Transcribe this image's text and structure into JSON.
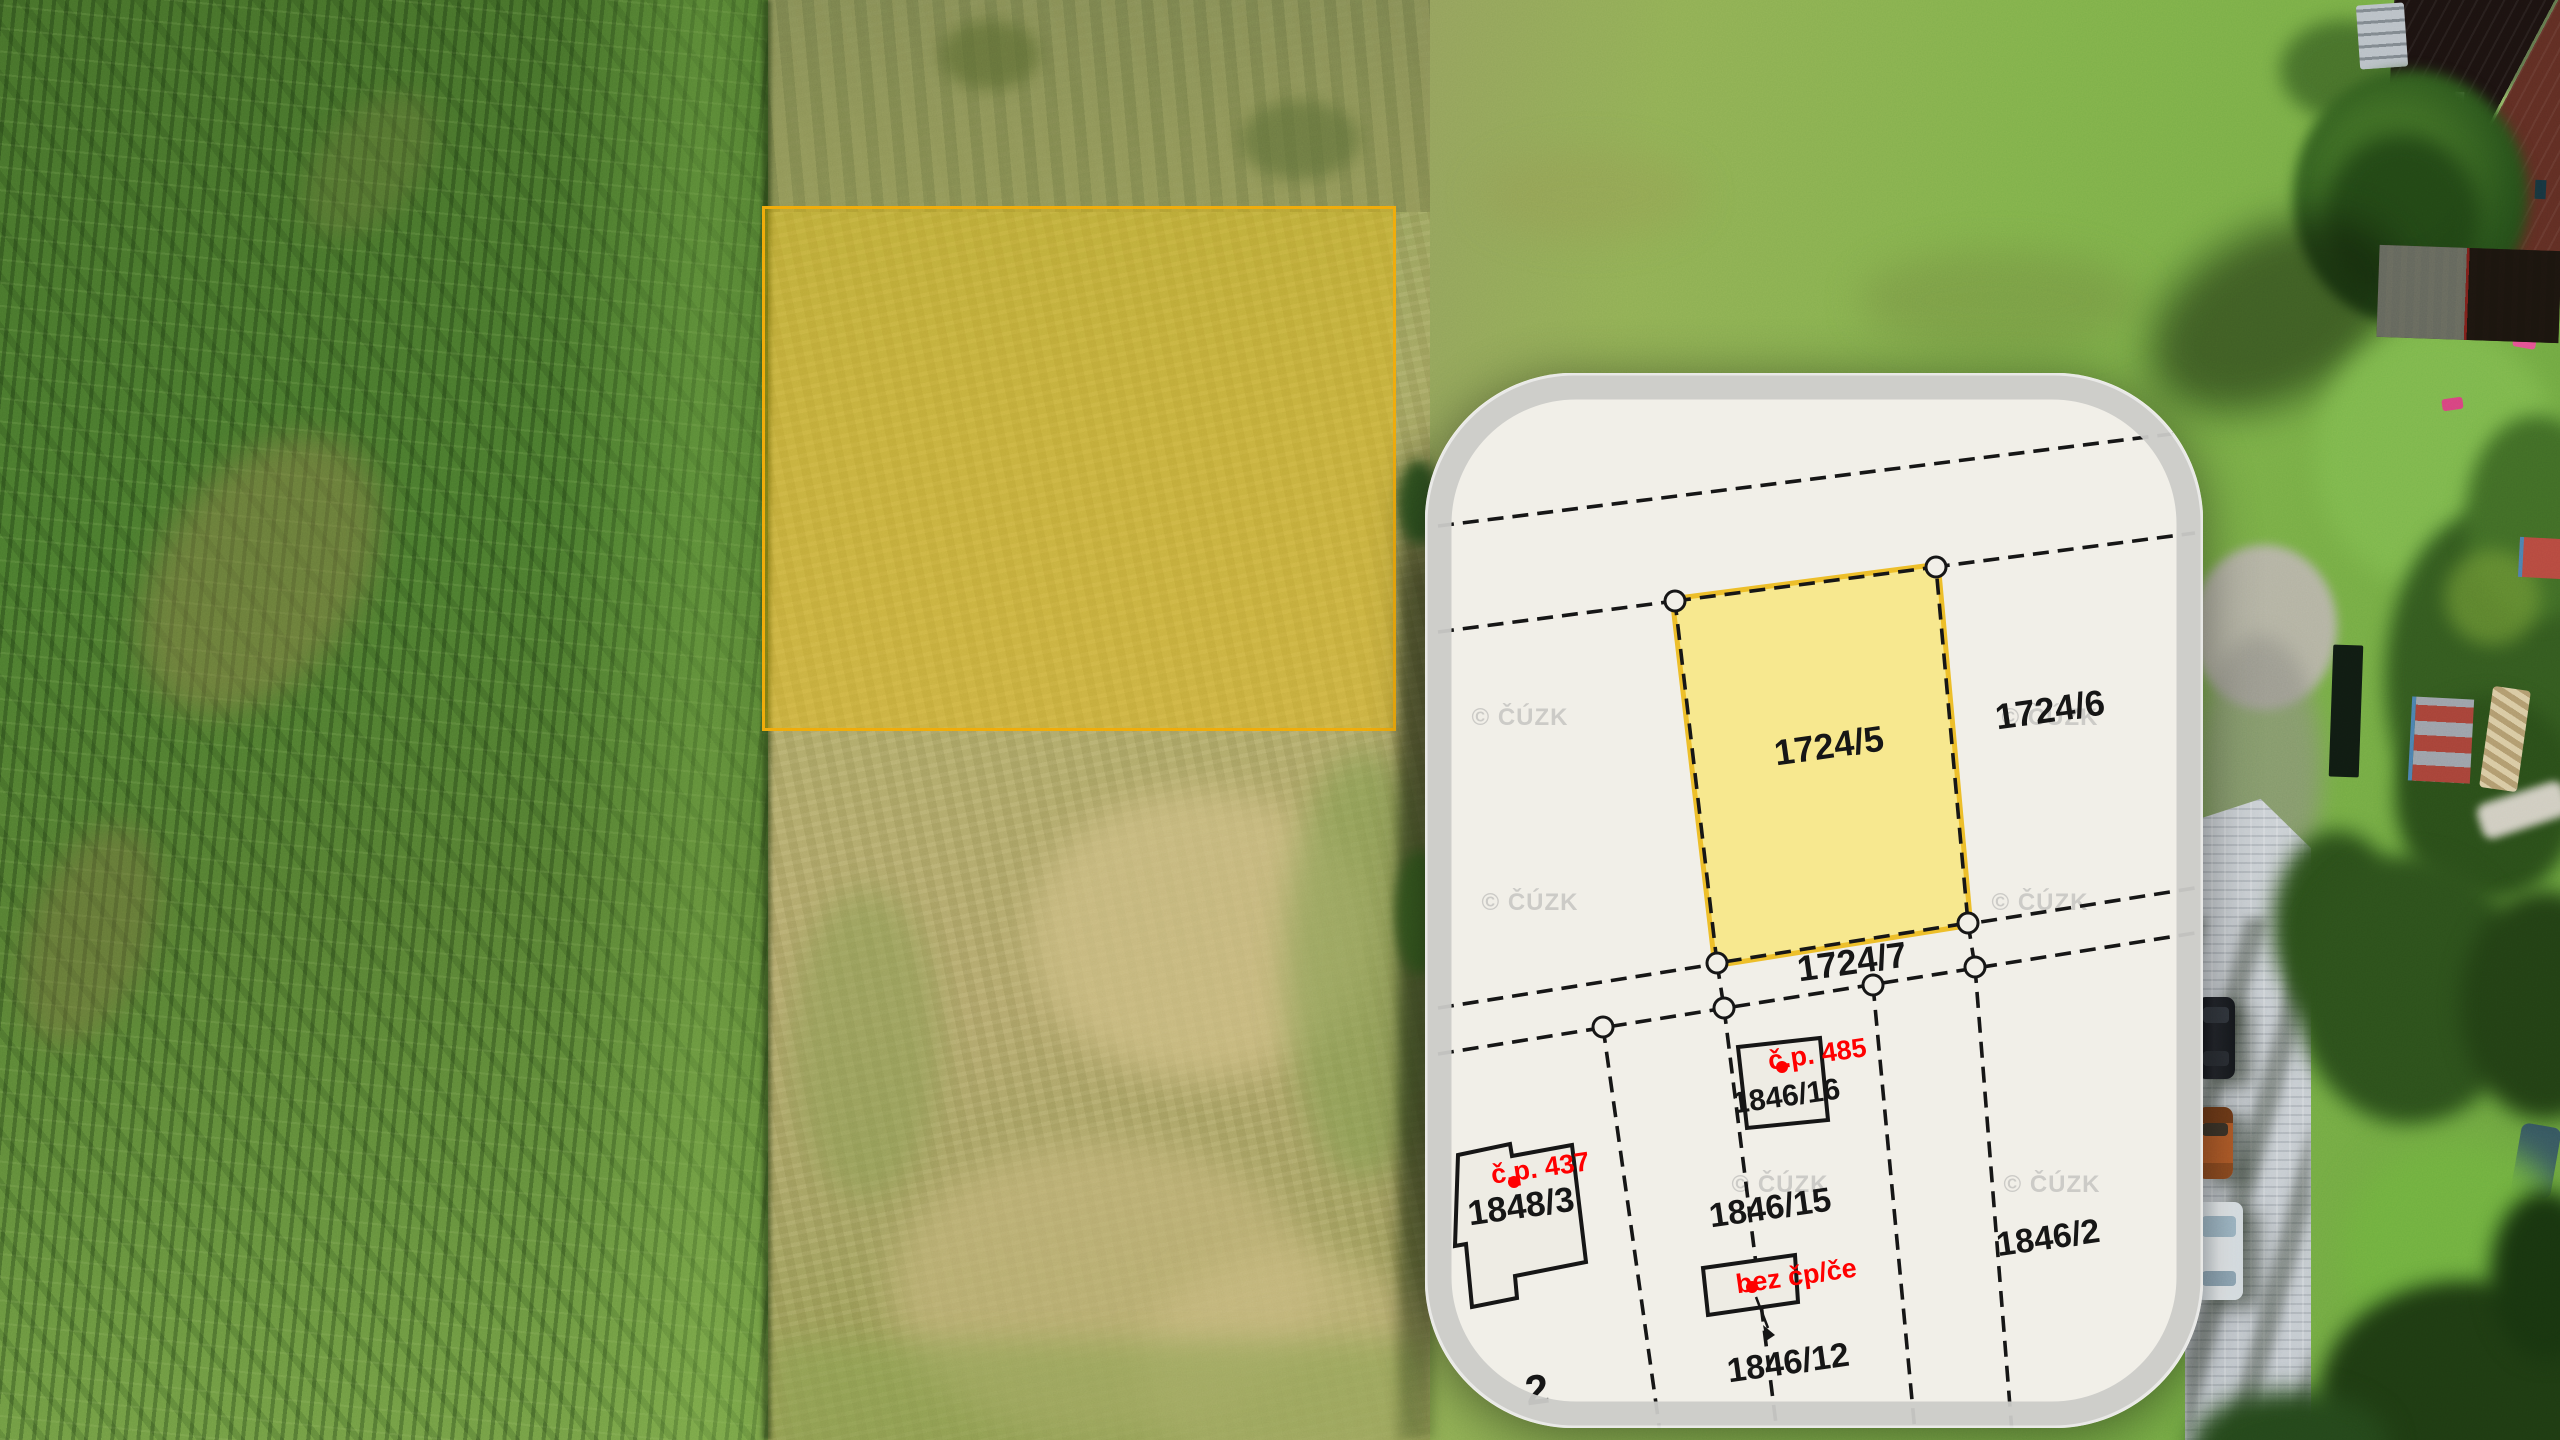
{
  "photo": {
    "highlight": {
      "border_color": "#f0a80a",
      "fill_color": "rgba(246,190,8,0.40)"
    }
  },
  "inset_map": {
    "watermark_text": "© ČÚZK",
    "colors": {
      "map_background": "#f1efe8",
      "frame": "#ccccca",
      "boundary_line": "#161616",
      "highlight_parcel_fill": "#f7e88f",
      "highlight_parcel_rim": "#edbf2a",
      "label": "#161616",
      "red_label": "#ff0000",
      "watermark": "#9b9b9b"
    },
    "parcel_labels": {
      "p1724_5": "1724/5",
      "p1724_6": "1724/6",
      "p1724_7": "1724/7",
      "p1846_16": "1846/16",
      "p1846_15": "1846/15",
      "p1848_3": "1848/3",
      "p1846_12": "1846/12",
      "p1846_2": "1846/2",
      "partial_left": "2"
    },
    "house_labels": {
      "cp485": "č.p. 485",
      "cp437": "č.p. 437",
      "bez_cpce": "bez čp/če"
    }
  }
}
